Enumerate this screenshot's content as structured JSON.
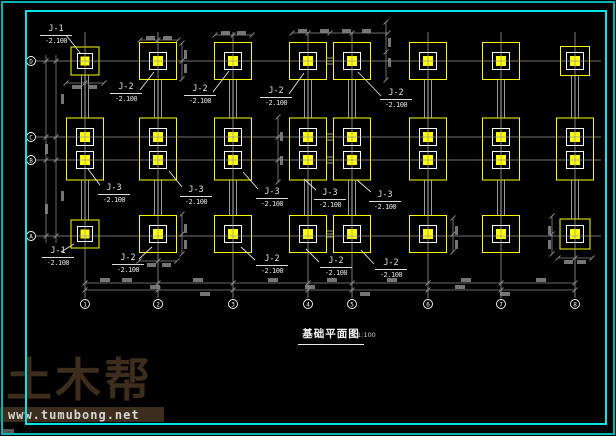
{
  "frame": {
    "outer_color": "#00b4b4",
    "inner_color": "#00e6e6"
  },
  "title_block": {
    "title": "基础平面图",
    "scale": "1:100"
  },
  "watermark": {
    "brand": "土木帮",
    "url": "www.tumubong.net"
  },
  "drawing": {
    "colors": {
      "grid": "#9c9c9c",
      "beam": "#c4c4c4",
      "footing_outline": "#ffff00",
      "pad_stroke": "#ffffff",
      "pad_fill": "#ffff00",
      "dim": "#8a8a8a",
      "leader": "#e8e8e8",
      "bubble_stroke": "#ffffff",
      "bubble_text": "#ffffff"
    },
    "grid_extents": {
      "v_top": 32,
      "v_bottom": 298,
      "h_left": 36,
      "h_right": 601,
      "col_bubble_y": 304,
      "row_bubble_x": 31
    },
    "columns": [
      {
        "id": "1",
        "x": 85
      },
      {
        "id": "2",
        "x": 158
      },
      {
        "id": "3",
        "x": 233
      },
      {
        "id": "4",
        "x": 308
      },
      {
        "id": "5",
        "x": 352
      },
      {
        "id": "6",
        "x": 428
      },
      {
        "id": "7",
        "x": 501
      },
      {
        "id": "8",
        "x": 575
      }
    ],
    "rows": [
      {
        "id": "D",
        "y": 61
      },
      {
        "id": "C",
        "y": 137
      },
      {
        "id": "B",
        "y": 160
      },
      {
        "id": "A",
        "y": 236
      }
    ],
    "top_footings": {
      "cy": 61,
      "items": [
        {
          "col": 0,
          "size": 28,
          "type": "J-1"
        },
        {
          "col": 1,
          "size": 37,
          "type": "J-2"
        },
        {
          "col": 2,
          "size": 37,
          "type": "J-2"
        },
        {
          "col": 3,
          "size": 37,
          "type": "J-2"
        },
        {
          "col": 4,
          "size": 37,
          "type": "J-2"
        },
        {
          "col": 5,
          "size": 37,
          "type": "J-2"
        },
        {
          "col": 6,
          "size": 37,
          "type": "J-2"
        },
        {
          "col": 7,
          "size": 29,
          "type": "J-2"
        }
      ]
    },
    "mid_footings": {
      "w": 37,
      "h": 62,
      "cy": 149,
      "pad_rows": [
        137,
        160
      ],
      "type": "J-3"
    },
    "bottom_footings": {
      "cy": 234,
      "items": [
        {
          "col": 0,
          "size": 28,
          "type": "J-1"
        },
        {
          "col": 1,
          "size": 37,
          "type": "J-2"
        },
        {
          "col": 2,
          "size": 37,
          "type": "J-2"
        },
        {
          "col": 3,
          "size": 37,
          "type": "J-2"
        },
        {
          "col": 4,
          "size": 37,
          "type": "J-2"
        },
        {
          "col": 5,
          "size": 37,
          "type": "J-2"
        },
        {
          "col": 6,
          "size": 37,
          "type": "J-2"
        },
        {
          "col": 7,
          "size": 30,
          "type": "J-2"
        }
      ]
    },
    "pair_beam": {
      "x1": 326.5,
      "x2": 333.5,
      "rows": [
        61,
        137,
        160,
        234
      ]
    },
    "labels": [
      {
        "text": "J-1",
        "elev": "-2.100",
        "x": 40,
        "y": 24,
        "leader": [
          66,
          35,
          81,
          54
        ]
      },
      {
        "text": "J-2",
        "elev": "-2.100",
        "x": 110,
        "y": 82,
        "leader": [
          140,
          90,
          154,
          72
        ]
      },
      {
        "text": "J-2",
        "elev": "-2.100",
        "x": 184,
        "y": 84,
        "leader": [
          213,
          92,
          229,
          71
        ]
      },
      {
        "text": "J-2",
        "elev": "-2.100",
        "x": 260,
        "y": 86,
        "leader": [
          289,
          94,
          304,
          73
        ]
      },
      {
        "text": "J-2",
        "elev": "-2.100",
        "x": 380,
        "y": 88,
        "leader": [
          381,
          96,
          358,
          72
        ]
      },
      {
        "text": "J-3",
        "elev": "-2.100",
        "x": 98,
        "y": 183,
        "leader": [
          100,
          185,
          88,
          169
        ]
      },
      {
        "text": "J-3",
        "elev": "-2.100",
        "x": 180,
        "y": 185,
        "leader": [
          182,
          187,
          169,
          171
        ]
      },
      {
        "text": "J-3",
        "elev": "-2.100",
        "x": 256,
        "y": 187,
        "leader": [
          258,
          189,
          243,
          172
        ]
      },
      {
        "text": "J-3",
        "elev": "-2.100",
        "x": 314,
        "y": 188,
        "leader": [
          316,
          190,
          304,
          179
        ]
      },
      {
        "text": "J-3",
        "elev": "-2.100",
        "x": 369,
        "y": 190,
        "leader": [
          371,
          192,
          357,
          180
        ]
      },
      {
        "text": "J-1",
        "elev": "-2.100",
        "x": 42,
        "y": 246,
        "leader": [
          74,
          244,
          61,
          252
        ]
      },
      {
        "text": "J-2",
        "elev": "-2.100",
        "x": 112,
        "y": 253,
        "leader": [
          152,
          247,
          139,
          259
        ]
      },
      {
        "text": "J-2",
        "elev": "-2.100",
        "x": 256,
        "y": 254,
        "leader": [
          241,
          247,
          255,
          260
        ]
      },
      {
        "text": "J-2",
        "elev": "-2.100",
        "x": 320,
        "y": 256,
        "leader": [
          306,
          249,
          319,
          262
        ]
      },
      {
        "text": "J-2",
        "elev": "-2.100",
        "x": 375,
        "y": 258,
        "leader": [
          361,
          250,
          374,
          264
        ]
      }
    ],
    "dims": {
      "left_chain_x": [
        46,
        56
      ],
      "left_chain_span": [
        55,
        243
      ],
      "bottom_chain_y": [
        283,
        290
      ],
      "bottom_chain_span": [
        85,
        575
      ],
      "lines": [
        [
          140,
          40,
          178,
          40
        ],
        [
          215,
          35,
          252,
          35
        ],
        [
          292,
          33,
          388,
          33
        ],
        [
          66,
          83,
          104,
          83
        ],
        [
          182,
          43,
          182,
          79
        ],
        [
          386,
          22,
          386,
          80
        ],
        [
          278,
          117,
          278,
          182
        ],
        [
          182,
          214,
          182,
          254
        ],
        [
          453,
          218,
          453,
          252
        ],
        [
          552,
          216,
          552,
          254
        ],
        [
          139,
          261,
          177,
          261
        ],
        [
          558,
          258,
          592,
          258
        ]
      ],
      "ticks": [
        [
          158,
          40
        ],
        [
          233,
          35
        ],
        [
          308,
          33
        ],
        [
          330,
          33
        ],
        [
          352,
          33
        ],
        [
          85,
          83
        ],
        [
          182,
          61
        ],
        [
          386,
          52
        ],
        [
          278,
          137
        ],
        [
          278,
          160
        ],
        [
          182,
          234
        ],
        [
          453,
          234
        ],
        [
          552,
          234
        ],
        [
          158,
          261
        ],
        [
          575,
          258
        ]
      ],
      "blobs": [
        [
          61,
          94,
          3,
          10
        ],
        [
          45,
          144,
          3,
          10
        ],
        [
          61,
          191,
          3,
          10
        ],
        [
          45,
          204,
          3,
          10
        ],
        [
          146,
          36,
          9,
          4
        ],
        [
          163,
          36,
          9,
          4
        ],
        [
          221,
          31,
          9,
          4
        ],
        [
          237,
          31,
          9,
          4
        ],
        [
          298,
          29,
          9,
          4
        ],
        [
          320,
          29,
          9,
          4
        ],
        [
          342,
          29,
          9,
          4
        ],
        [
          362,
          29,
          9,
          4
        ],
        [
          72,
          85,
          9,
          4
        ],
        [
          88,
          85,
          9,
          4
        ],
        [
          184,
          50,
          3,
          9
        ],
        [
          184,
          64,
          3,
          9
        ],
        [
          388,
          38,
          3,
          9
        ],
        [
          388,
          58,
          3,
          9
        ],
        [
          280,
          132,
          3,
          9
        ],
        [
          280,
          156,
          3,
          9
        ],
        [
          184,
          224,
          3,
          9
        ],
        [
          184,
          240,
          3,
          9
        ],
        [
          455,
          226,
          3,
          9
        ],
        [
          455,
          240,
          3,
          9
        ],
        [
          548,
          226,
          3,
          9
        ],
        [
          548,
          240,
          3,
          9
        ],
        [
          147,
          263,
          9,
          4
        ],
        [
          162,
          263,
          9,
          4
        ],
        [
          564,
          260,
          9,
          4
        ],
        [
          577,
          260,
          9,
          4
        ],
        [
          100,
          278,
          10,
          4
        ],
        [
          122,
          278,
          10,
          4
        ],
        [
          193,
          278,
          10,
          4
        ],
        [
          268,
          278,
          10,
          4
        ],
        [
          327,
          278,
          10,
          4
        ],
        [
          387,
          278,
          10,
          4
        ],
        [
          461,
          278,
          10,
          4
        ],
        [
          536,
          278,
          10,
          4
        ],
        [
          150,
          285,
          10,
          4
        ],
        [
          305,
          285,
          10,
          4
        ],
        [
          455,
          285,
          10,
          4
        ],
        [
          200,
          292,
          10,
          4
        ],
        [
          360,
          292,
          10,
          4
        ],
        [
          500,
          292,
          10,
          4
        ]
      ]
    }
  }
}
